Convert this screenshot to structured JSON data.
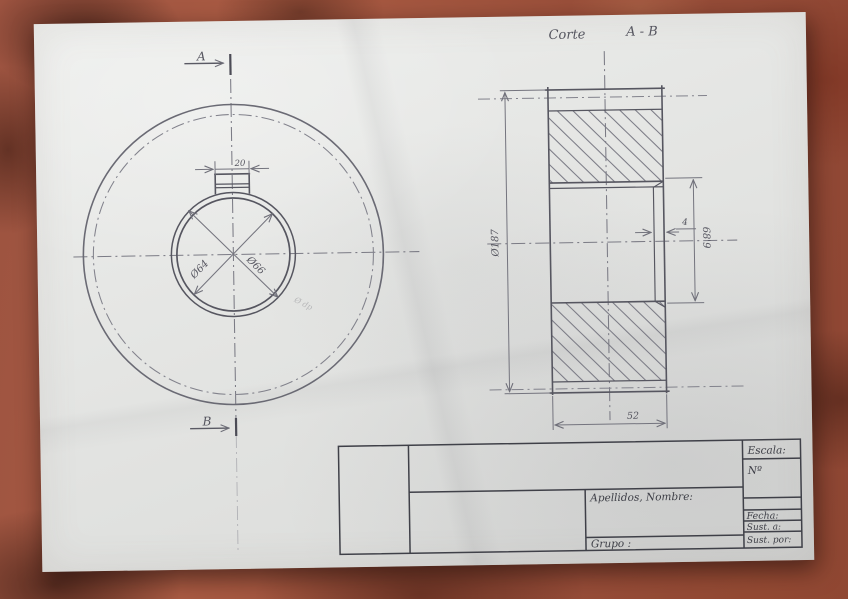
{
  "annotations": {
    "corte": "Corte",
    "ab": "A - B"
  },
  "front_view": {
    "cut_label_top": "A",
    "cut_label_bottom": "B",
    "dim_keyway_width": "20",
    "dim_bore": "Ø64",
    "dim_hub": "Ø66",
    "faint_note": "Ø dp"
  },
  "section_view": {
    "dim_outer_diameter": "Ø187",
    "dim_bore_keyway": "68'9",
    "dim_chamfer": "4",
    "dim_width": "52"
  },
  "title_block": {
    "escala": "Escala:",
    "numero": "Nº",
    "apellidos": "Apellidos, Nombre:",
    "fecha": "Fecha:",
    "sust_a": "Sust. a:",
    "sust_por": "Sust. por:",
    "grupo": "Grupo :"
  },
  "colors": {
    "pencil": "#6b6b75",
    "dark_pencil": "#565660",
    "ink": "#3f4048",
    "paper": "#e7e7e4",
    "brick": "#a0523e"
  }
}
